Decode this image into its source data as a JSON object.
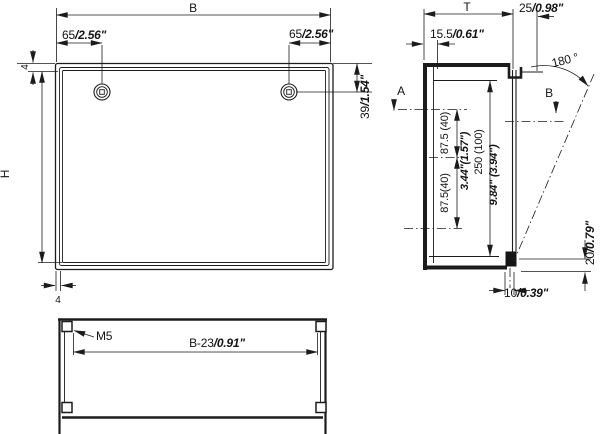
{
  "drawing": {
    "front_view": {
      "width_label": "B",
      "height_label": "H",
      "screw_offset_left": {
        "mm": "65",
        "inch": "/2.56\""
      },
      "screw_offset_right": {
        "mm": "65",
        "inch": "/2.56\""
      },
      "screw_drop": {
        "mm": "39",
        "inch": "/1.54\""
      },
      "flange_top": "4",
      "flange_side": "4"
    },
    "side_view": {
      "depth_label": "T",
      "front_depth": {
        "mm": "15.5",
        "inch": "/0.61\""
      },
      "hinge_offset": {
        "mm": "25",
        "inch": "/0.98\""
      },
      "opening_angle": "180 °",
      "section_a_label": "A",
      "section_b_label": "B",
      "hole_pitch_upper": "87.5 (40)",
      "hole_pitch_lower": "87.5(40)",
      "hole_pitch_inch": "3.44\"(1.57\")",
      "cutout_height": "250 (100)",
      "cutout_height_inch": "9.84\" (3.94\")",
      "pin_to_bottom": {
        "mm": "20",
        "inch": "/0.79\""
      },
      "pin_width": {
        "mm": "10",
        "inch": "/0.39\""
      }
    },
    "bottom_view": {
      "thread_label": "M5",
      "hole_spacing": {
        "mm": "B-23",
        "inch": "/0.91\""
      }
    }
  }
}
